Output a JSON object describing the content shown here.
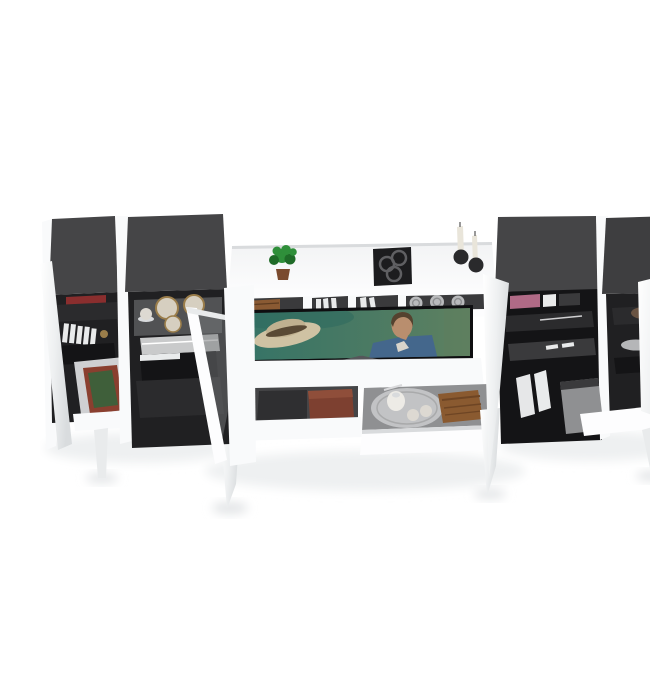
{
  "image": {
    "title": "White high-gloss media wall unit with open doors and drawers, dark grey tops and interiors, TV at center showing a film scene",
    "width": 650,
    "height": 650
  },
  "labels": {
    "scene": "Entertainment wall unit product render",
    "cabinet_a": "Left tall cabinet with shelves, magazines and framed picture",
    "cabinet_b": "Left display cabinet with glass shelf, plates and open glass door",
    "center_unit": "Center TV hutch with cubbies, open drawers and decor",
    "cabinet_c": "Right cabinet with shelves, binders and open door",
    "cabinet_d": "Far right cabinet with bowl, plate, open door and pull-out drawer",
    "tv": "Flat screen TV showing a man in a blue shirt and a straw hat on teal water",
    "plant": "Small green potted plant",
    "wall_art": "Black square tray with three round dishes",
    "candles": "Two candlesticks with dark round bases",
    "cubby_shelf": "Open cubby shelf with books and three silver spheres",
    "drawer_left": "Open drawer with dark box and red book",
    "drawer_right": "Pulled-out drawer with silver tray, pitcher, cups and wooden book",
    "framed_picture": "Green canvas in rust frame",
    "plates": "Gold-rimmed plates and cup on glass shelf",
    "floor_shadow": "Soft floor shadow"
  },
  "colors": {
    "bg": "#ffffff",
    "white": "#f9fafb",
    "whiteBright": "#fdfdfe",
    "whiteShade": "#e9ebec",
    "whiteDim": "#d9dbdd",
    "darkTop": "#454547",
    "darkTopB": "#3e3e40",
    "interior": "#202022",
    "interiorDeep": "#141416",
    "shelf": "#2b2b2d",
    "shelfLight": "#3a3a3c",
    "bezel": "#0e0e10",
    "screenTeal": "#3a7b6d",
    "screenGreen": "#5d7d5e",
    "screenDark": "#2e6a5e",
    "hat": "#cfc2a3",
    "hatCrown": "#c0b190",
    "hatBand": "#5a4a35",
    "skin": "#b98e6e",
    "hair": "#55422f",
    "shirt": "#44678c",
    "tee": "#d8d4cb",
    "legGrey": "#55565a",
    "plantGreen": "#2f8f3a",
    "plantDark": "#1f6b28",
    "potBrown": "#7a4a2e",
    "frameBlack": "#1c1c1e",
    "ringGrey": "#5f5f62",
    "candleDark": "#2a2a2c",
    "candleWax": "#e9e5da",
    "woodBook": "#8a5a33",
    "silverBall": "#b9babc",
    "silverBallShade": "#8d8e90",
    "redBook": "#8a2e2e",
    "magazineWhite": "#e9eaea",
    "glassTint": "#75787a",
    "plateGold": "#9a7d4a",
    "plateCream": "#d6cfc0",
    "cupWhite": "#ddd9d2",
    "pileGrey": "#c9cacb",
    "drawerBox": "#2f2f31",
    "drawerBookRed": "#7d4030",
    "drawerBookRedTop": "#8f4e3a",
    "traySilver": "#c2c3c5",
    "trayEdge": "#a9aaab",
    "pitcherWhite": "#edebe6",
    "grainBook": "#8a5a30",
    "grainDark": "#6e4524",
    "canvasGreen": "#3f5f3a",
    "frameRust": "#8a3f2f",
    "matGrey": "#cfd0d2",
    "binderWhite": "#e6e7e8",
    "pinkSpine": "#b06a86",
    "bowlBrown": "#6a5443",
    "plateSilver": "#b5b6b8",
    "drawerGrey": "#8f9092",
    "cavityGrey": "#454547",
    "shadow": "#eef0f1",
    "shadowDark": "#e2e4e6"
  }
}
